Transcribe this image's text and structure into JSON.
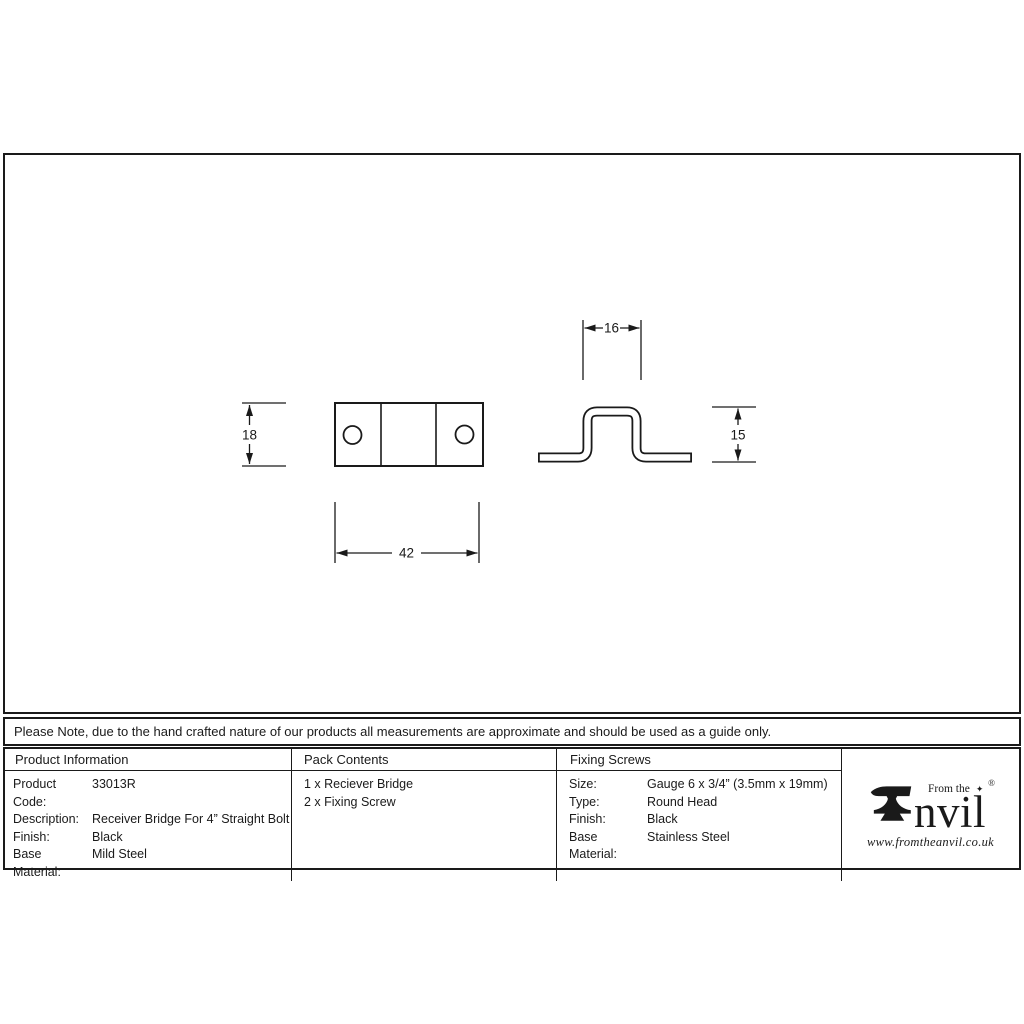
{
  "note": {
    "text": "Please Note, due to the hand crafted nature of our products all measurements are approximate and should be used as a guide only."
  },
  "drawing": {
    "plan_view": {
      "height_label": "18",
      "width_label": "42"
    },
    "profile_view": {
      "top_width_label": "16",
      "height_label": "15"
    }
  },
  "table": {
    "product_information": {
      "header": "Product Information",
      "rows": [
        {
          "label": "Product Code:",
          "value": "33013R"
        },
        {
          "label": "Description:",
          "value": "Receiver Bridge For 4” Straight Bolt"
        },
        {
          "label": "Finish:",
          "value": "Black"
        },
        {
          "label": "Base Material:",
          "value": "Mild Steel"
        }
      ]
    },
    "pack_contents": {
      "header": "Pack Contents",
      "items": [
        "1 x Reciever Bridge",
        "2 x Fixing Screw"
      ]
    },
    "fixing_screws": {
      "header": "Fixing Screws",
      "rows": [
        {
          "label": "Size:",
          "value": "Gauge 6 x 3/4” (3.5mm x 19mm)"
        },
        {
          "label": "Type:",
          "value": "Round Head"
        },
        {
          "label": "Finish:",
          "value": "Black"
        },
        {
          "label": "Base Material:",
          "value": "Stainless Steel"
        }
      ]
    }
  },
  "logo": {
    "from_the": "From the",
    "diamond": "✦",
    "registered": "®",
    "brand": "nvil",
    "website": "www.fromtheanvil.co.uk"
  },
  "colors": {
    "line": "#1a1a1a",
    "background": "#ffffff"
  }
}
